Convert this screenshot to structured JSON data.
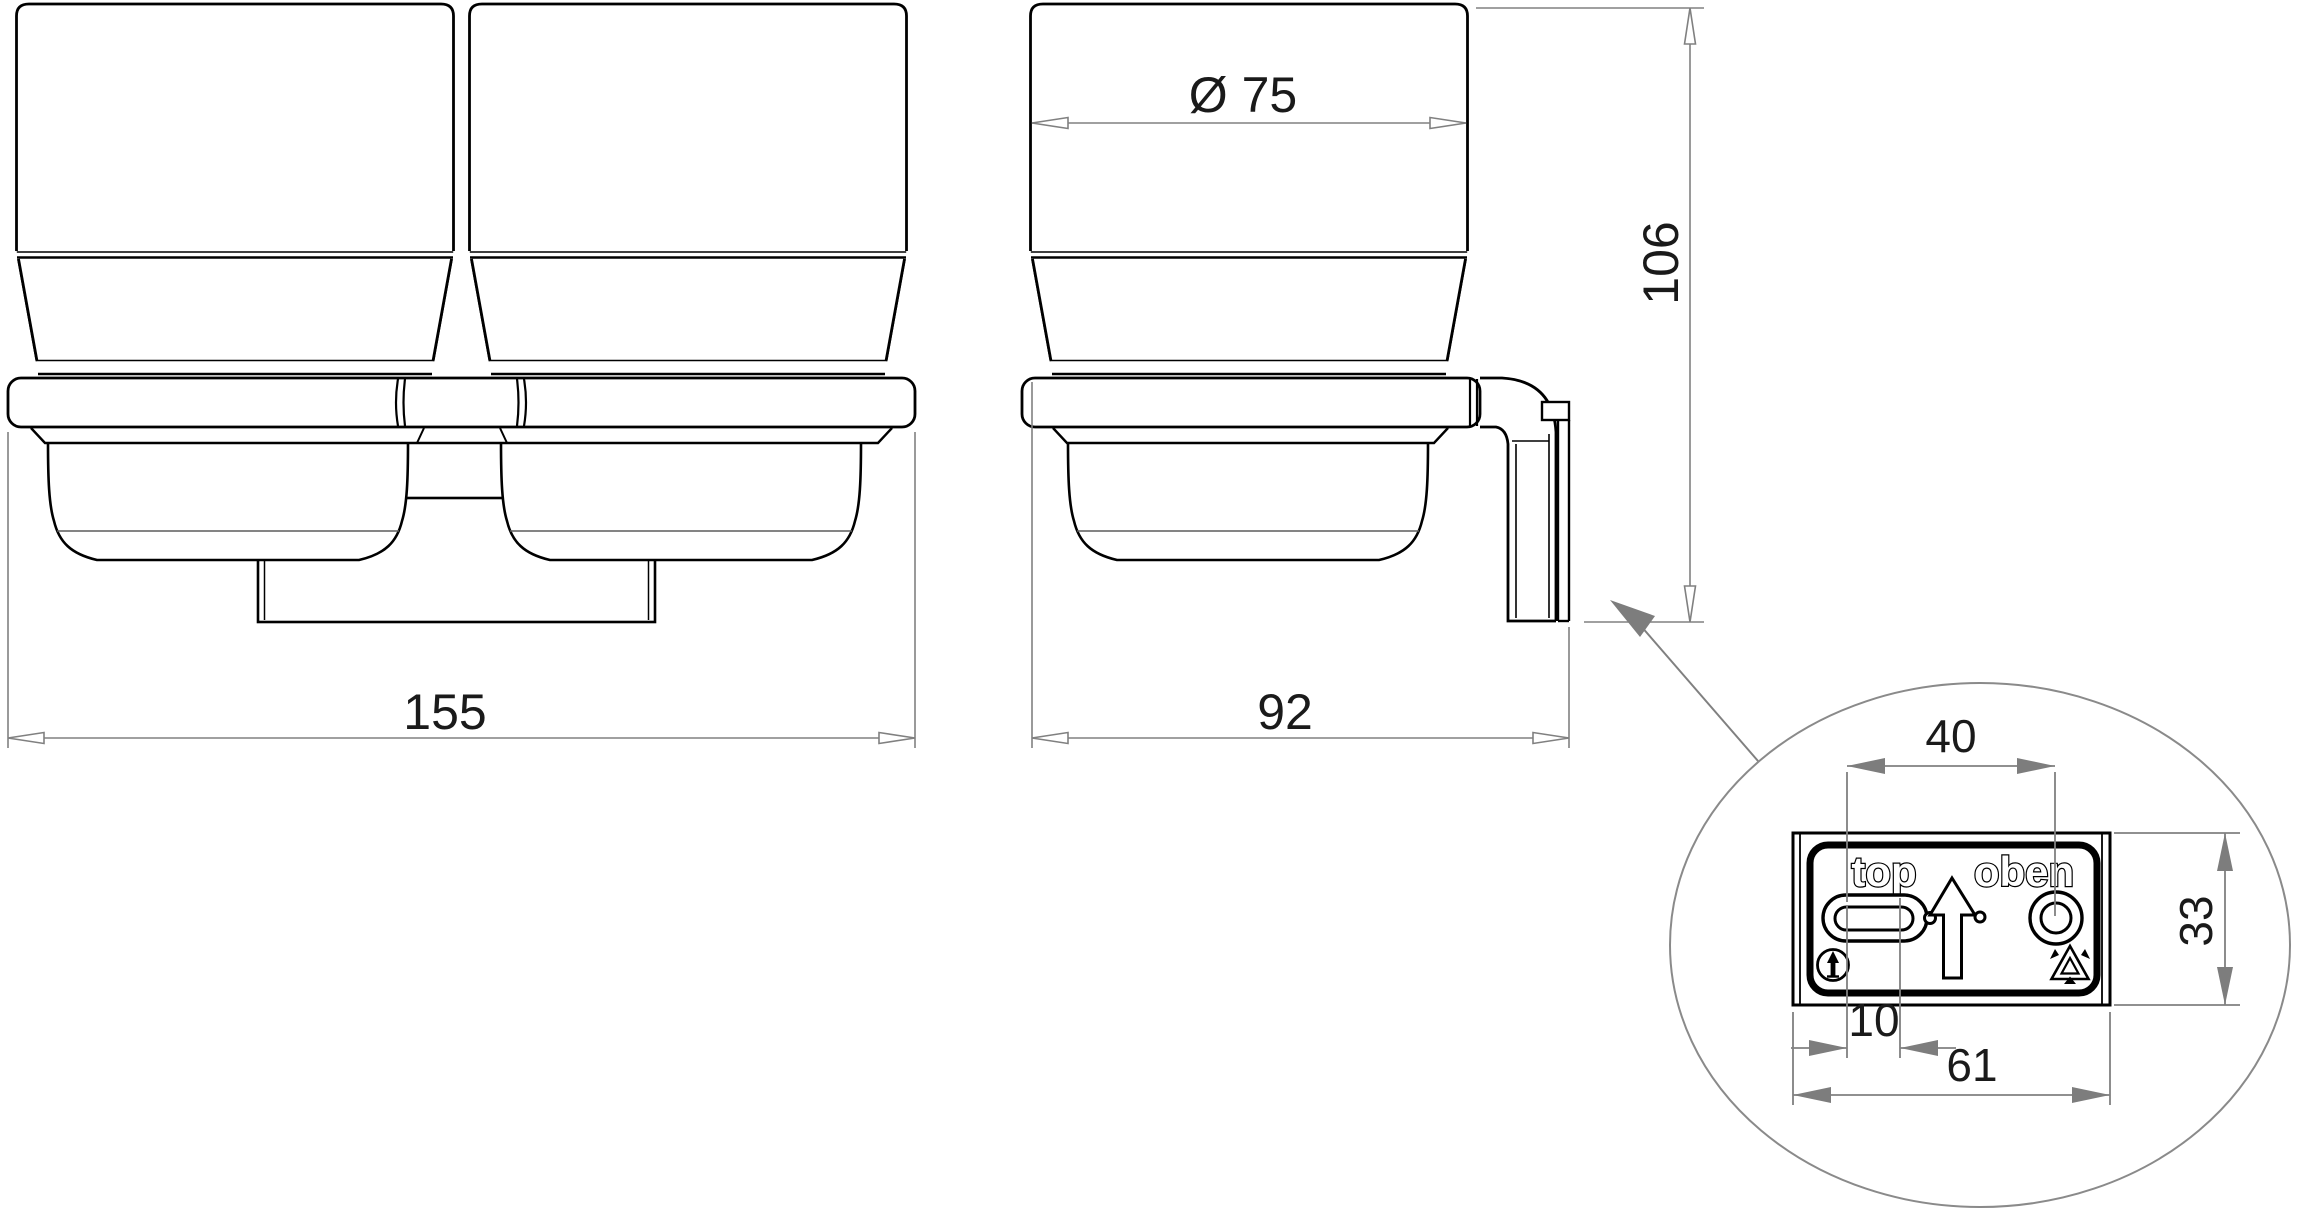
{
  "page": {
    "background": "#ffffff"
  },
  "colors": {
    "part_line": "#000000",
    "dim_line": "#808080",
    "text": "#1a1a1a"
  },
  "dimensions": {
    "front_overall_width": "155",
    "side_depth": "92",
    "cup_diameter": "Ø 75",
    "side_height": "106",
    "detail_hole_spacing": "40",
    "detail_plate_height": "33",
    "detail_slot_length": "10",
    "detail_plate_width": "61"
  },
  "detail_markings": {
    "top": "top",
    "oben": "oben"
  },
  "icons": {
    "this_side_up": "circled-up-arrow-icon",
    "recycling": "recycling-triangle-icon",
    "orientation_arrow": "up-arrow-marking"
  }
}
